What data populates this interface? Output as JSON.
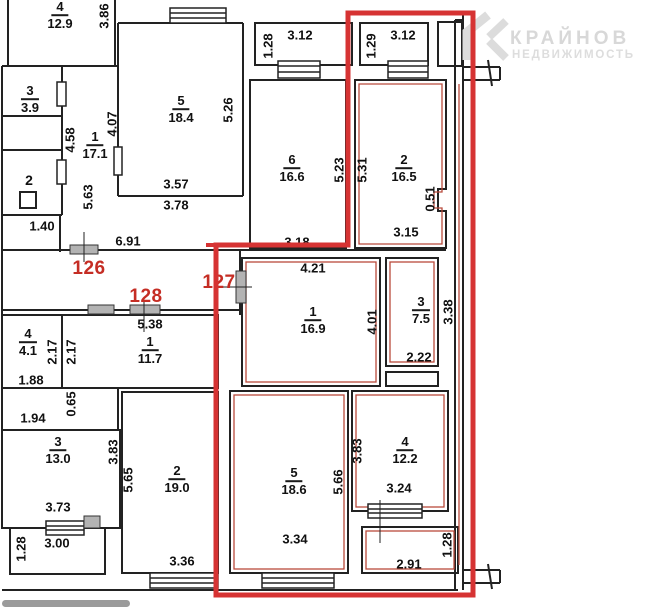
{
  "plan": {
    "watermark": {
      "brand": "КРАЙНОВ",
      "tagline": "НЕДВИЖИМОСТЬ"
    },
    "apartment_numbers": {
      "left": "126",
      "center": "128",
      "right": "127"
    },
    "rooms": [
      {
        "num": "4",
        "area": "12.9"
      },
      {
        "num": "3",
        "area": "3.9"
      },
      {
        "num": "1",
        "area": "17.1"
      },
      {
        "num": "2",
        "area": ""
      },
      {
        "num": "5",
        "area": "18.4"
      },
      {
        "num": "6",
        "area": "16.6"
      },
      {
        "num": "2",
        "area": "16.5"
      },
      {
        "num": "1",
        "area": "16.9"
      },
      {
        "num": "3",
        "area": "7.5"
      },
      {
        "num": "5",
        "area": "18.6"
      },
      {
        "num": "4",
        "area": "12.2"
      },
      {
        "num": "4",
        "area": "4.1"
      },
      {
        "num": "1",
        "area": "11.7"
      },
      {
        "num": "3",
        "area": "13.0"
      },
      {
        "num": "2",
        "area": "19.0"
      }
    ],
    "dimensions": [
      "3.86",
      "4.58",
      "4.07",
      "5.63",
      "1.40",
      "5.26",
      "3.57",
      "3.78",
      "6.91",
      "3.12",
      "1.28",
      "3.12",
      "1.29",
      "5.23",
      "5.31",
      "0.51",
      "3.18",
      "3.15",
      "4.21",
      "4.01",
      "3.38",
      "2.22",
      "5.38",
      "2.17",
      "2.17",
      "1.88",
      "1.94",
      "0.65",
      "3.83",
      "5.65",
      "3.73",
      "3.00",
      "1.28",
      "3.36",
      "3.34",
      "5.66",
      "3.83",
      "3.24",
      "2.91",
      "1.28"
    ],
    "colors": {
      "wall": "#222222",
      "highlight_outline": "#d63333",
      "apartment_contour": "#b94a3c",
      "apartment_number_red": "#c52d24",
      "watermark_gray": "#d8d8d8",
      "scrollbar_gray": "#9b9b9b"
    }
  }
}
